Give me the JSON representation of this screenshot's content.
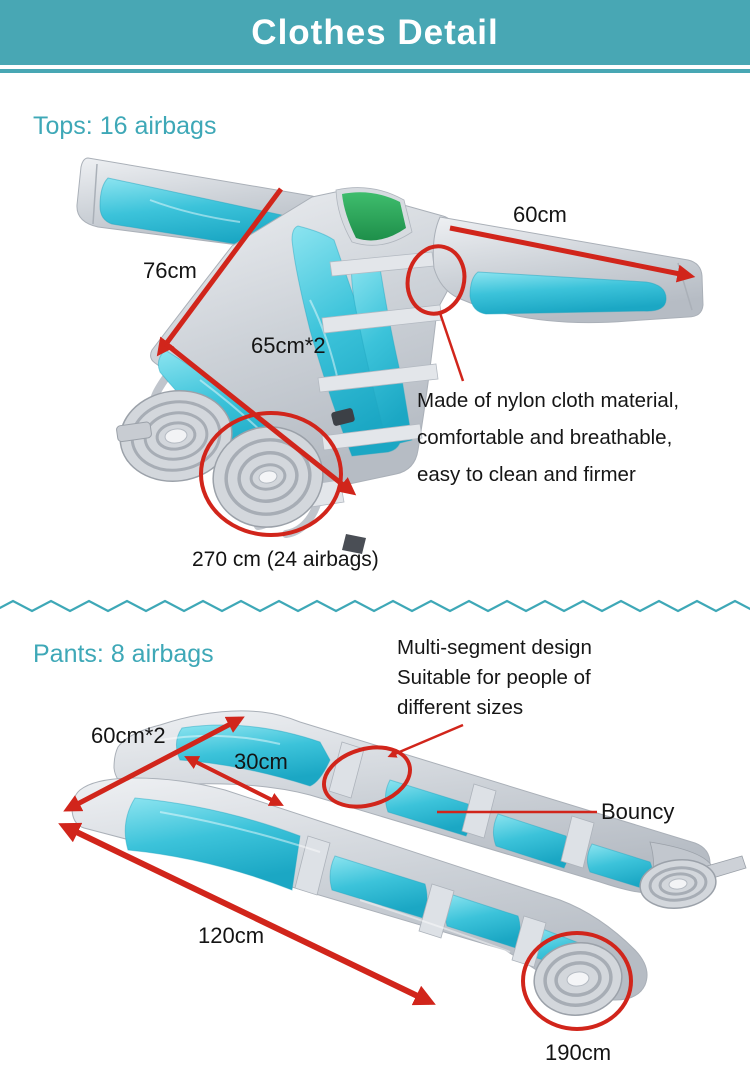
{
  "header": {
    "title": "Clothes Detail"
  },
  "tops": {
    "heading": "Tops: 16 airbags",
    "measurements": {
      "sleeve_length": "60cm",
      "body_height": "76cm",
      "body_width": "65cm*2"
    },
    "note_lines": [
      "Made of nylon cloth material,",
      "comfortable and breathable,",
      "easy to clean and firmer"
    ],
    "hose_caption": "270 cm (24 airbags)"
  },
  "pants": {
    "heading": "Pants: 8 airbags",
    "note_lines": [
      "Multi-segment design",
      "Suitable for people of",
      "different sizes"
    ],
    "measurements": {
      "hip_width": "60cm*2",
      "segment_width": "30cm",
      "leg_length": "120cm",
      "hose_length": "190cm"
    },
    "bouncy_label": "Bouncy"
  },
  "colors": {
    "header_bg": "#48a7b4",
    "accent_teal": "#3ea8b7",
    "annotation_red": "#d1251b",
    "fabric_cyan": "#3cc3da",
    "fabric_grey": "#ccd1d8",
    "collar_green": "#2ea55c"
  }
}
